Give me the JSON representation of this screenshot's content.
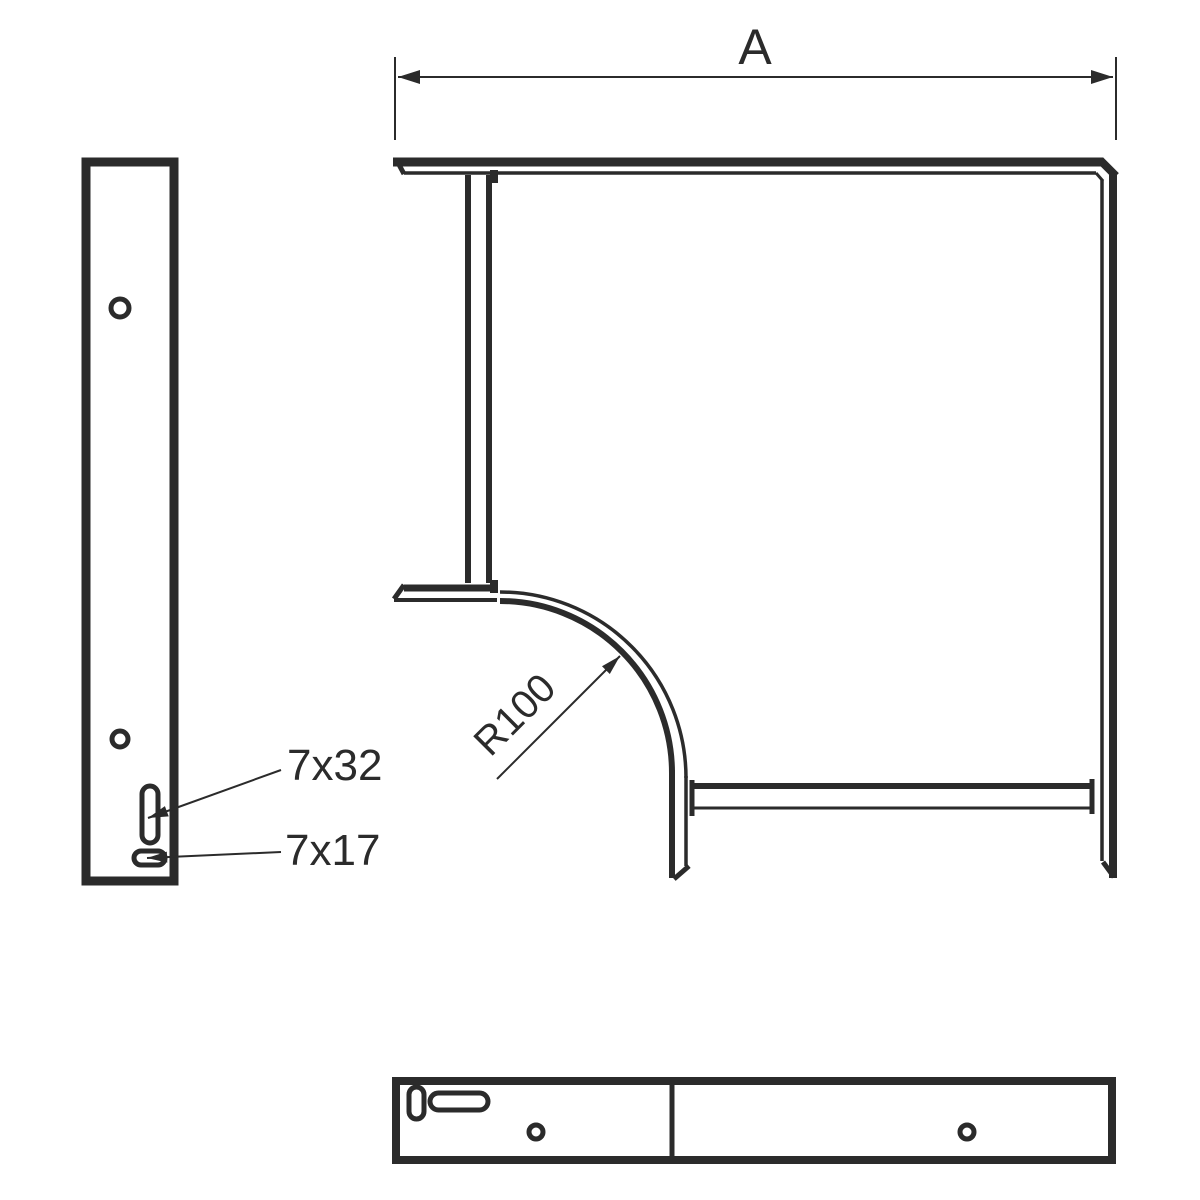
{
  "drawing": {
    "background_color": "#ffffff",
    "line_color": "#2b2b2b",
    "labels": {
      "dimension_a": "A",
      "radius": "R100",
      "slot_vertical": "7x32",
      "slot_horizontal": "7x17"
    }
  }
}
